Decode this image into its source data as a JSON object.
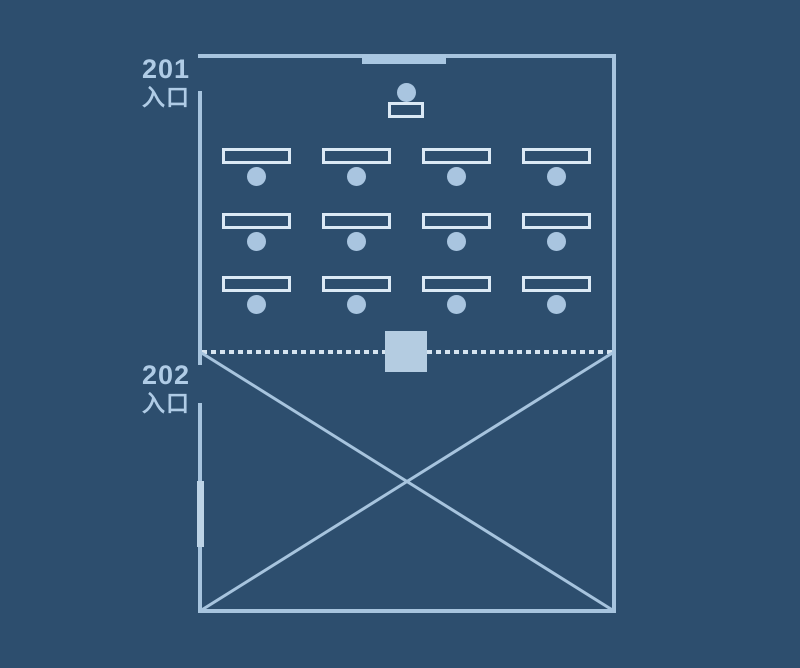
{
  "palette": {
    "background": "#2d4e6e",
    "wall": "#a7c4de",
    "furniture_border": "#dbe9f5",
    "seat_fill": "#a9c5e0",
    "equipment_fill": "#b4cce1",
    "whiteboard_fill": "#a9c7e2",
    "divider_dot": "#d6e4f0",
    "label_text": "#b0cce6"
  },
  "labels": {
    "entrance_201": {
      "number": "201",
      "text": "入口"
    },
    "entrance_202": {
      "number": "202",
      "text": "入口"
    }
  },
  "floor_plan": {
    "room_upper": "201",
    "room_lower": "202",
    "seating": {
      "rows": 3,
      "columns": 4,
      "total_seats": 12
    },
    "front_area": {
      "whiteboard": "whiteboard-strip",
      "presenter_seat": "seat-circle",
      "podium": "podium-rectangle"
    },
    "divider": {
      "style": "dotted-line",
      "equipment_box": "filled-square"
    },
    "lower_room": {
      "content": "diagonal-cross",
      "door_panel": "left-wall-panel"
    }
  }
}
